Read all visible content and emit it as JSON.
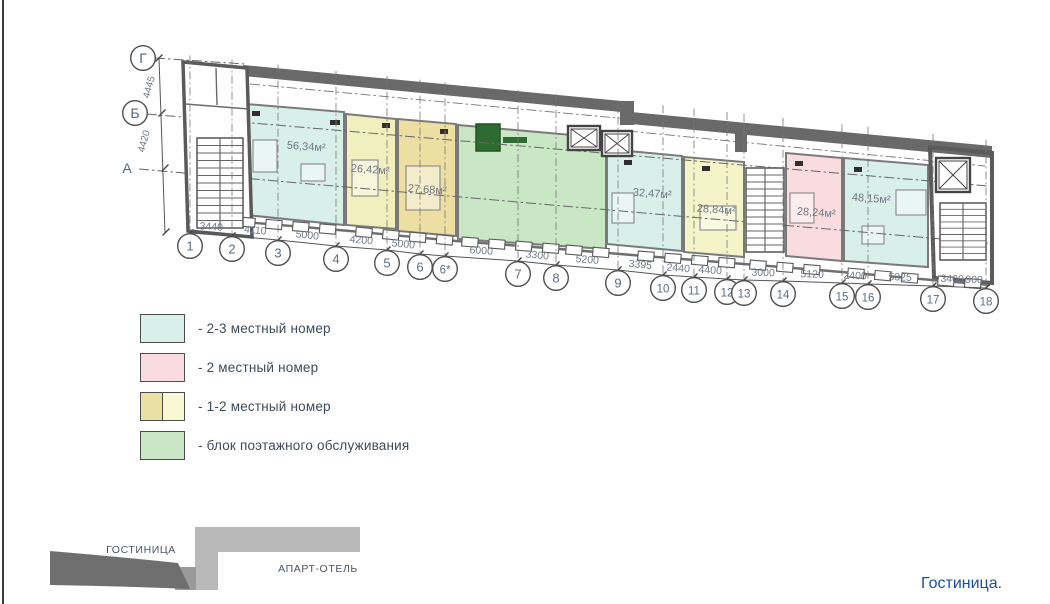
{
  "drawing": {
    "caption": "Гостиница.",
    "axes": {
      "rows": [
        "Г",
        "Б",
        "А"
      ],
      "row_dims": [
        "4445",
        "4420"
      ],
      "cols": [
        "1",
        "2",
        "3",
        "4",
        "5",
        "6",
        "6*",
        "7",
        "8",
        "9",
        "10",
        "11",
        "12",
        "13",
        "14",
        "15",
        "16",
        "17",
        "18"
      ],
      "col_dims": [
        "3440",
        "4110",
        "5000",
        "4200",
        "5000",
        "6000",
        "3300",
        "5200",
        "3395",
        "2440",
        "4400",
        "3000",
        "5120",
        "2400",
        "5325",
        "3400",
        "900"
      ]
    },
    "rooms": [
      {
        "area": "56,34м²",
        "fill": "#d9efe9"
      },
      {
        "area": "26,42м²",
        "fill": "#f0efbd"
      },
      {
        "area": "27,68м²",
        "fill": "#ecdfa1"
      },
      {
        "area": "32,47м²",
        "fill": "#d9efe9"
      },
      {
        "area": "28,84м²",
        "fill": "#f4f4c8"
      },
      {
        "area": "28,24м²",
        "fill": "#f9dcdf"
      },
      {
        "area": "48,15м²",
        "fill": "#d9efe9"
      }
    ],
    "service_block_fill": "#c9e6c5",
    "wall_color": "#696969"
  },
  "legend": {
    "items": [
      {
        "label": "- 2-3 местный номер",
        "colors": [
          "#d9efe9"
        ]
      },
      {
        "label": "- 2 местный номер",
        "colors": [
          "#f9dcdf"
        ]
      },
      {
        "label": "- 1-2 местный номер",
        "colors": [
          "#e9e0a2",
          "#f7f7d0"
        ]
      },
      {
        "label": "- блок поэтажного обслуживания",
        "colors": [
          "#c9e6c5"
        ]
      }
    ]
  },
  "key_plan": {
    "hotel_label": "ГОСТИНИЦА",
    "apart_label": "АПАРТ-ОТЕЛЬ"
  }
}
